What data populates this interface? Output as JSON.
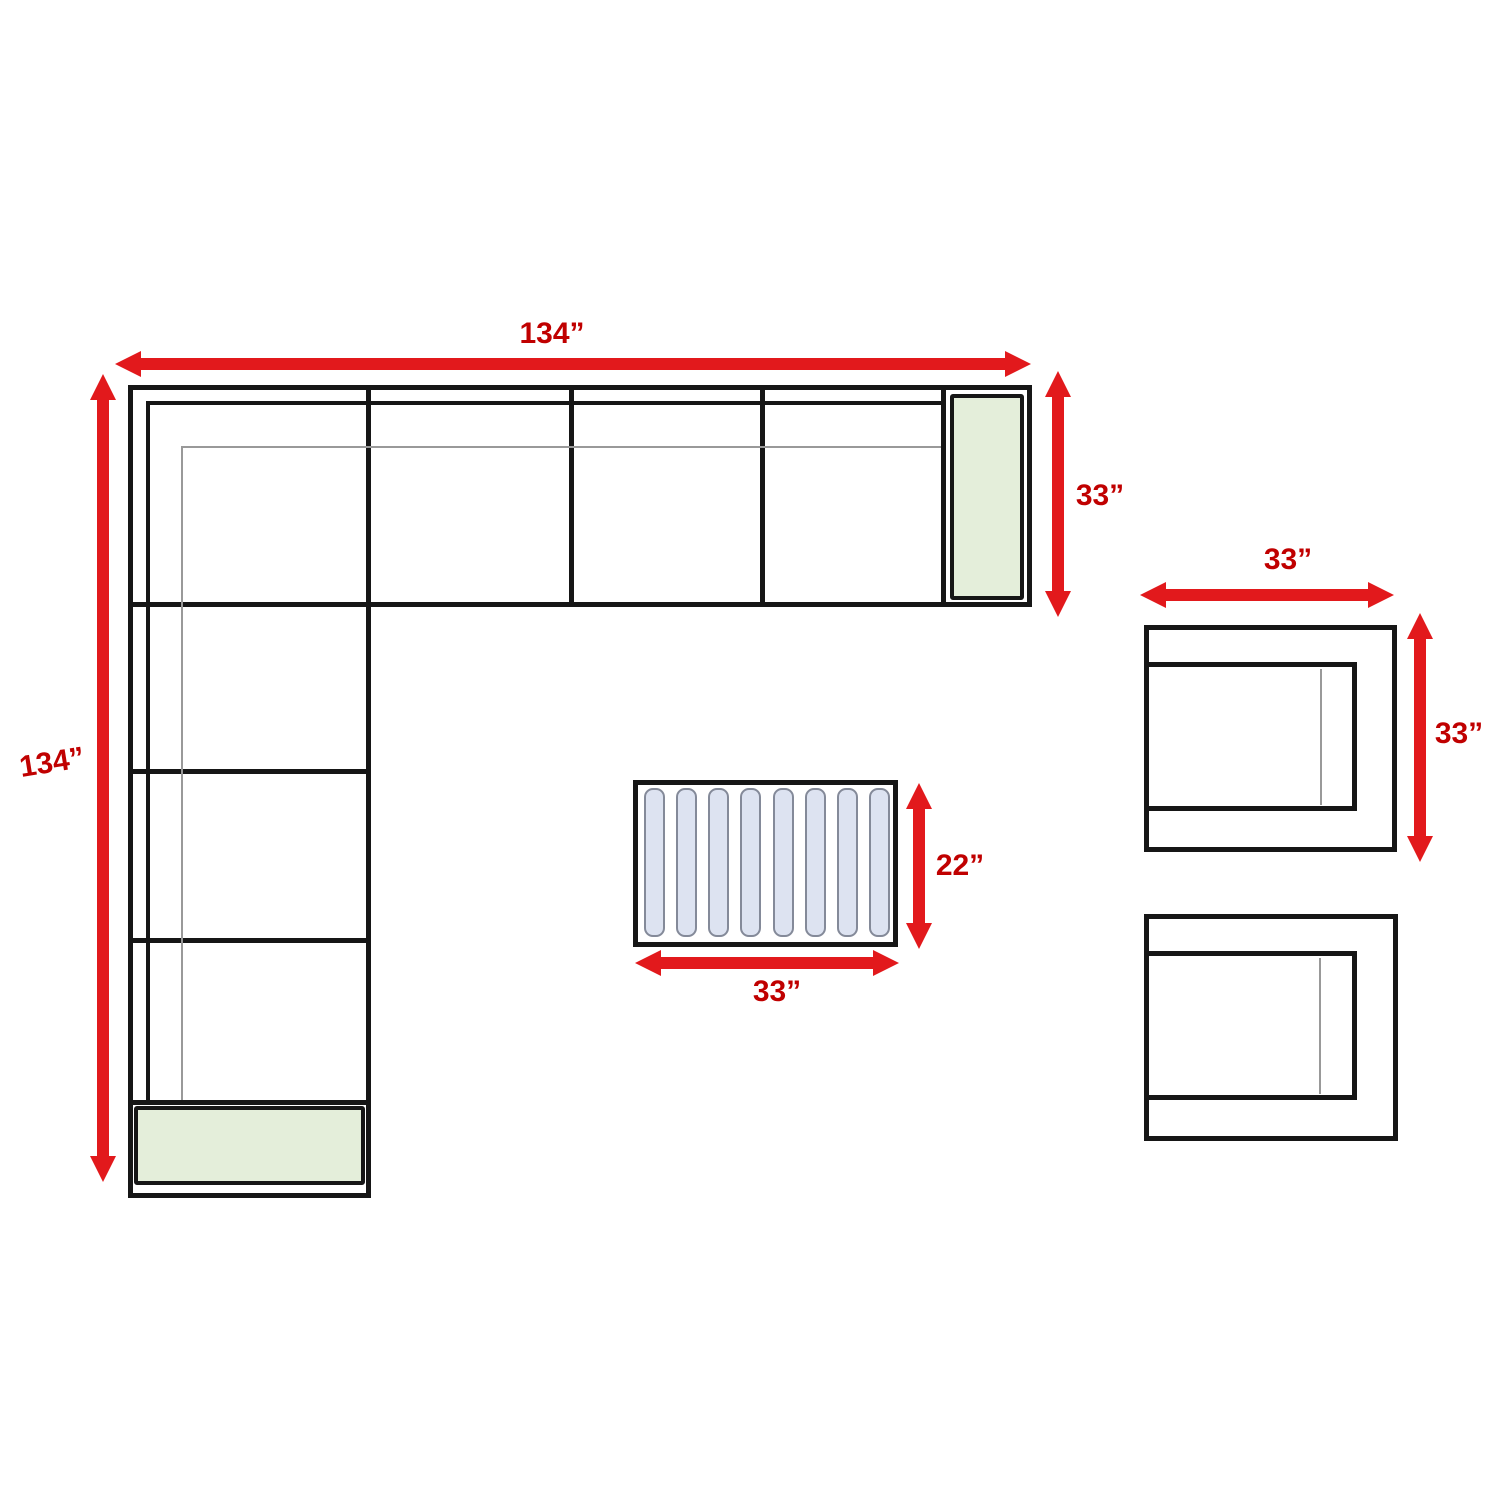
{
  "diagram": {
    "type": "furniture-dimension-floor-plan",
    "pieces": [
      "l-shaped-sectional-sofa",
      "coffee-table",
      "armchair",
      "armchair"
    ]
  },
  "dims": {
    "sofa_width": "134”",
    "sofa_height": "134”",
    "sofa_depth": "33”",
    "chair_width": "33”",
    "chair_depth": "33”",
    "table_width": "33”",
    "table_depth": "22”"
  },
  "coffee_table": {
    "slat_count": 8
  },
  "colors": {
    "arrow_red": "#e2191c",
    "label_red": "#c00000",
    "outline_black": "#161616",
    "thin_gray": "#999999",
    "cushion_green": "#e4eeda",
    "slat_blue": "#dde3f1",
    "slat_border": "#848a99",
    "background": "#ffffff"
  }
}
